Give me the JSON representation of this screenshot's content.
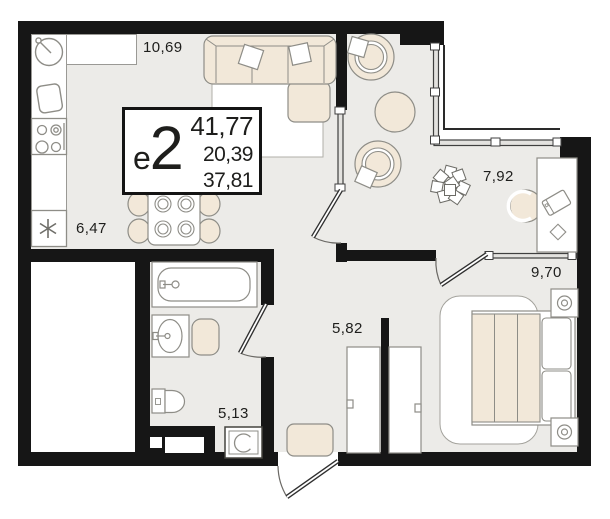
{
  "plan": {
    "unit_card": {
      "type_label_letter": "е",
      "type_label_number": "2",
      "area_main": "41,77",
      "area_secondary": "20,39",
      "area_tertiary": "37,81"
    },
    "room_areas": {
      "kitchen_living": "10,69",
      "kitchen_niche": "6,47",
      "lounge": "7,92",
      "bedroom": "9,70",
      "hallway": "5,82",
      "bathroom": "5,13"
    },
    "colors": {
      "wall": "#161616",
      "floor": "#ecebe8",
      "furniture_fill": "#f2e8d9",
      "furniture_outline": "#8e8d87",
      "card_border": "#141414",
      "text": "#1e1e1c",
      "background": "#ffffff"
    },
    "icons": [
      "sink-icon",
      "cutting-board-icon",
      "stove-icon",
      "fridge-asterisk-icon",
      "dining-table",
      "sofa",
      "armchair",
      "pouf",
      "plant-icon",
      "desk",
      "laptop-icon",
      "mouse-icon",
      "bed",
      "nightstand-lamp-icon",
      "wardrobe",
      "bathtub-icon",
      "washbasin-icon",
      "toilet-icon",
      "washing-machine-icon",
      "doormat",
      "door-swing",
      "window-glazing"
    ]
  }
}
